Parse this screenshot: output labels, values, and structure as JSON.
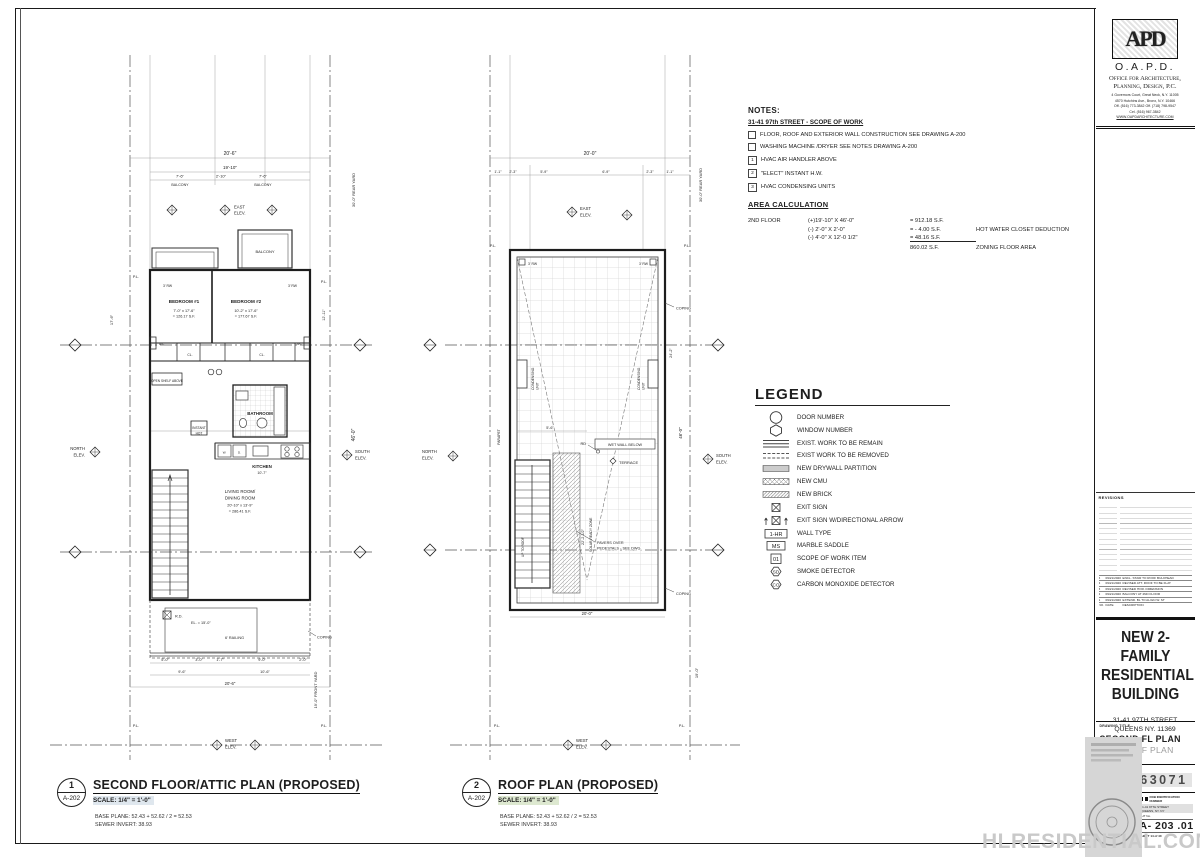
{
  "sheet": {
    "watermark": "HLRESIDENTIAL.COM"
  },
  "notes": {
    "title": "NOTES:",
    "subtitle": "31-41 97th STREET - SCOPE OF WORK",
    "checkbox_items": [
      "FLOOR, ROOF AND EXTERIOR WALL CONSTRUCTION SEE DRAWING A-200",
      "WASHING MACHINE /DRYER SEE NOTES DRAWING A-200"
    ],
    "numbered_items": [
      {
        "num": "1",
        "text": "HVAC AIR HANDLER ABOVE"
      },
      {
        "num": "2",
        "text": "\"ELECT\" INSTANT H.W."
      },
      {
        "num": "3",
        "text": "HVAC CONDENSING UNITS"
      }
    ]
  },
  "area": {
    "title": "AREA CALCULATION",
    "floor": "2ND FLOOR",
    "rows": [
      {
        "f": "(+)19'-10\" X 46'-0\"",
        "v": "= 912.18 S.F.",
        "n": ""
      },
      {
        "f": "(-) 2'-0\" X 2'-0\"",
        "v": "=  - 4.00 S.F.",
        "n": "HOT WATER CLOSET DEDUCTION"
      },
      {
        "f": "(-) 4'-0\" X 12'-0 1/2\"",
        "v": "=  48.16 S.F.",
        "n": ""
      },
      {
        "f": "",
        "v": "860.02 S.F.",
        "n": "ZONING FLOOR AREA"
      }
    ]
  },
  "legend": {
    "title": "LEGEND",
    "items": [
      {
        "label": "DOOR NUMBER"
      },
      {
        "label": "WINDOW  NUMBER"
      },
      {
        "label": "EXIST. WORK TO BE REMAIN"
      },
      {
        "label": "EXIST WORK TO BE REMOVED"
      },
      {
        "label": "NEW DRYWALL PARTITION"
      },
      {
        "label": "NEW CMU"
      },
      {
        "label": "NEW BRICK"
      },
      {
        "label": "EXIT SIGN"
      },
      {
        "label": "EXIT SIGN W/DIRECTIONAL ARROW"
      },
      {
        "label": "WALL TYPE",
        "symbol_text": "1-HR"
      },
      {
        "label": "MARBLE SADDLE",
        "symbol_text": "MS"
      },
      {
        "label": "SCOPE OF WORK ITEM",
        "symbol_text": "01"
      },
      {
        "label": "SMOKE DETECTOR",
        "symbol_text": "SD"
      },
      {
        "label": "CARBON MONOXIDE DETECTOR",
        "symbol_text": "CO"
      }
    ]
  },
  "plan1": {
    "bubble_num": "1",
    "bubble_ref": "A-202",
    "title": "SECOND FLOOR/ATTIC PLAN (PROPOSED)",
    "scale": "SCALE: 1/4\" = 1'-0\"",
    "base_plane": "BASE PLANE: 52.43 + 52.62 / 2 = 52.53",
    "sewer": "SEWER INVERT: 38.93",
    "labels": {
      "dim_total": "20'-6\"",
      "dim_inner": "19'-10\"",
      "seg1": "7'-6\"",
      "seg2": "2'-10\"",
      "seg3": "7'-6\"",
      "balcony": "BALCONY",
      "east": "EAST",
      "elev": "ELEV.",
      "north": "NORTH",
      "south": "SOUTH",
      "west": "WEST",
      "pl": "P.L.",
      "rw": "3' RW",
      "rear_yard": "30'-0\" REAR YARD",
      "front_yard": "19'-0\" FRONT YARD",
      "bed1": "BEDROOM #1",
      "bed1_dim": "7'-0\" x 17'-6\"",
      "bed1_area": "= 126.17 S.F.",
      "bed2": "BEDROOM #2",
      "bed2_dim": "10'-2\" x 17'-6\"",
      "bed2_area": "= 177.67 S.F.",
      "dim_17_6": "17'-6\"",
      "dim_12_11": "12'-11\"",
      "ac": "A/C",
      "cl": "CL.",
      "open_shelf": "OPEN SHELF ABOVE",
      "bathroom": "BATHROOM",
      "instant1": "INSTANT",
      "instant2": "HOT",
      "kitchen": "KITCHEN",
      "kitchen_dim": "10'-7\"",
      "kitchen_w": "W.",
      "kitchen_d": "D.",
      "living1": "LIVING ROOM/",
      "living2": "DINING ROOM",
      "living_dim": "20'-10\" x 13'-9\"",
      "living_area": "= 286.41 S.F.",
      "rd": "R.D.",
      "el": "EL. = 15'-0\"",
      "railing": "6' RAILING",
      "coping": "COPING",
      "b1": "5'-0\"",
      "b2": "3'-0\"",
      "b3": "1'-7\"",
      "b4": "9'-0\"",
      "b5": "2'-0\"",
      "b6": "9'-6\"",
      "b7": "10'-6\"",
      "b8": "20'-6\"",
      "dim_46": "46'-0\""
    }
  },
  "plan2": {
    "bubble_num": "2",
    "bubble_ref": "A-202",
    "title": "ROOF PLAN (PROPOSED)",
    "scale": "SCALE: 1/4\" = 1'-0\"",
    "base_plane": "BASE PLANE: 52.43 + 52.62 / 2 = 52.53",
    "sewer": "SEWER INVERT: 38.93",
    "labels": {
      "dim_total": "20'-0\"",
      "s1": "1'-1\"",
      "s2": "2'-3\"",
      "s3": "5'-9\"",
      "s4": "6'-9\"",
      "s5": "2'-3\"",
      "s6": "1'-1\"",
      "east": "EAST",
      "elev": "ELEV.",
      "north": "NORTH",
      "south": "SOUTH",
      "west": "WEST",
      "pl": "P.L.",
      "rw": "3' RW",
      "coping": "COPING",
      "parapet": "PARAPET",
      "cond1": "CONDENSING",
      "cond2": "UNIT",
      "rd": "RD",
      "wet_wall": "WET WALL BELOW",
      "terrace": "TERRACE",
      "solar": "SOLAR READY ZONE",
      "pavers1": "PAVERS OVER",
      "pavers2": "PEDESTALS - SEE DWG.",
      "stair": "UP TO ROOF",
      "dim_5_6": "5'-6\"",
      "dim_22": "22'-2 1/2\"",
      "dim_24": "24'-2\"",
      "dim_46": "46'-0\"",
      "dim_bottom": "20'-0\"",
      "rear_yard": "30'-0\" REAR YARD",
      "dim_19": "19'-0\""
    }
  },
  "titleblock": {
    "monogram": "APD",
    "firm": "O.A.P.D.",
    "firm_line1": "Office for Architecture,",
    "firm_line2": "Planning, Design, P.C.",
    "addr1": "4 Governors Court, Great Neck, N.Y. 11005",
    "addr2": "4570 Hutchins Ave., Bronx, N.Y. 10466",
    "phone1": "Off. (516) 773-3842     Off. (718) 798-9547",
    "phone2": "Cel. (516) 967-3842",
    "website": "WWW.OAPDARCHITECTURE.COM",
    "revisions_label": "REVISIONS",
    "revisions": [
      {
        "num": "5",
        "date": "09/21/2020",
        "desc": "ENCL. STAIR TO ROOF BULKHEAD"
      },
      {
        "num": "4",
        "date": "09/21/2020",
        "desc": "REVISED ATT. ROOF TO BE FLAT"
      },
      {
        "num": "3",
        "date": "09/21/2020",
        "desc": "REVISED HOR. DIMENSION"
      },
      {
        "num": "2",
        "date": "09/21/2020",
        "desc": "BALCONY AT 2ND FLOOR"
      },
      {
        "num": "1",
        "date": "09/21/2020",
        "desc": "EXTEND. BL TO ALIGN W. ST"
      },
      {
        "num": "NO.",
        "date": "DATE",
        "desc": "DESCRIPTION"
      }
    ],
    "project": [
      "NEW 2-FAMILY",
      "RESIDENTIAL",
      "BUILDING"
    ],
    "project_addr1": "31-41 97TH STREET",
    "project_addr2": "QUEENS NY. 11369",
    "drawing_title_label": "DRAWING TITLE",
    "drawing_title1": "SECOND FL PLAN",
    "drawing_title2": "AND ROOF PLAN",
    "sticker_label": "B- SCAN  JOB  STICKER",
    "job_number": "420663071",
    "dob_label": "DOB IDENTIFICATION NUMBER",
    "stamp_addr1": "31-41 97TH STREET",
    "stamp_addr2": "QUEENS, NY. NY",
    "sht_label": "SHT No.",
    "sheet_number": "A- 203 .01",
    "sheet_of": "SHEET 14 of 40"
  }
}
